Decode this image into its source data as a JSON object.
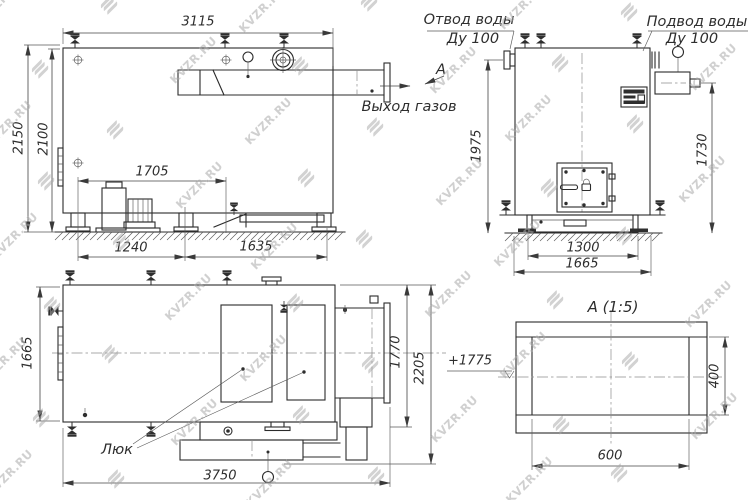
{
  "watermark": {
    "text": "KVZR.RU"
  },
  "side_view": {
    "dim_width": "3115",
    "dim_height_total": "2150",
    "dim_height_shell": "2100",
    "dim_fan": "1705",
    "dim_front_segment": "1240",
    "dim_rear_segment": "1635",
    "gas_outlet_label": "Выход газов",
    "view_arrow_letter": "А"
  },
  "front_view": {
    "water_outlet_title": "Отвод воды",
    "water_outlet_dn": "Ду 100",
    "water_inlet_title": "Подвод воды",
    "water_inlet_dn": "Ду 100",
    "dim_outlet_height": "1975",
    "dim_inlet_height": "1730",
    "dim_base": "1300",
    "dim_overall_width": "1665"
  },
  "top_view": {
    "dim_width": "1665",
    "dim_1770": "1770",
    "dim_2205": "2205",
    "dim_overall_length": "3750",
    "hatch_label": "Люк"
  },
  "detail_view": {
    "title": "А (1:5)",
    "dim_height": "400",
    "dim_width": "600",
    "elevation_mark": "+1775"
  }
}
